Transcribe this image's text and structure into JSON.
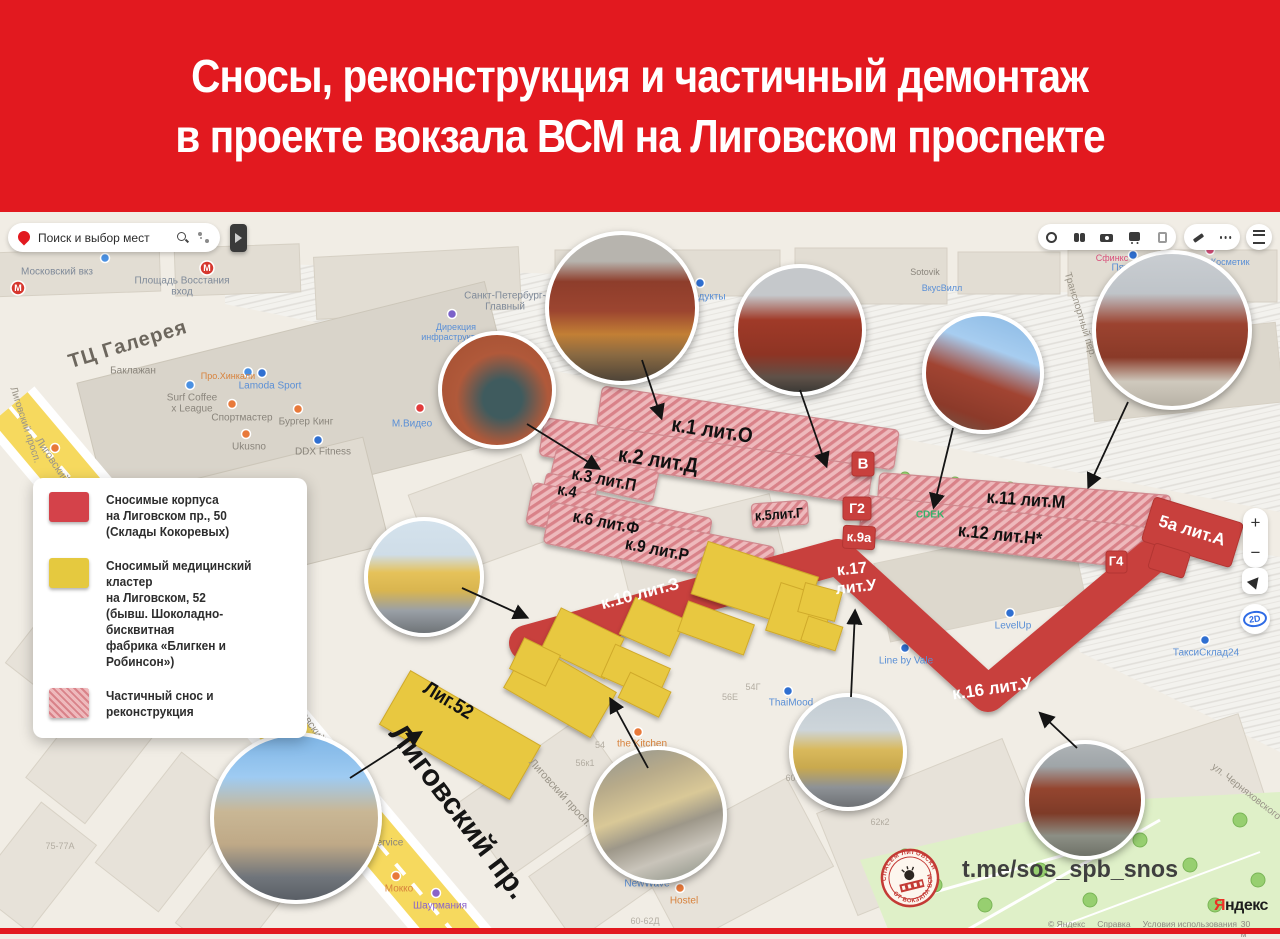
{
  "header": {
    "line1": "Сносы, реконструкция и частичный демонтаж",
    "line2": "в проекте вокзала ВСМ на Лиговском проспекте"
  },
  "search": {
    "placeholder": "Поиск и выбор мест"
  },
  "map_controls": {
    "zoom_in": "+",
    "zoom_out": "−",
    "view_2d": "2D"
  },
  "legend": {
    "items": [
      {
        "swatch": "red",
        "lines": [
          "Сносимые корпуса",
          "на Лиговском пр., 50",
          "(Склады Кокоревых)"
        ]
      },
      {
        "swatch": "yellow",
        "lines": [
          "Сносимый медицинский кластер",
          "на Лиговском, 52",
          "(бывш. Шоколадно-бисквитная",
          "фабрика «Блигкен и Робинсон»)"
        ]
      },
      {
        "swatch": "hatched",
        "lines": [
          "Частичный снос и реконструкция"
        ]
      }
    ]
  },
  "colors": {
    "banner_red": "#e2191f",
    "overlay_red": "#c8403e",
    "overlay_yellow": "#e8c83f",
    "hatch_pink": "#eeb9bc"
  },
  "building_labels": [
    {
      "t": "к.1 лит.О",
      "x": 712,
      "y": 431,
      "r": 8.5,
      "s": 21,
      "c": "#111",
      "w": 700,
      "sx": 0.9
    },
    {
      "t": "к.2 лит.Д",
      "x": 658,
      "y": 461,
      "r": 8.5,
      "s": 21,
      "c": "#111",
      "w": 700,
      "sx": 0.9
    },
    {
      "t": "к.3 лит.П",
      "x": 604,
      "y": 480,
      "r": 11,
      "s": 17,
      "c": "#111",
      "w": 700,
      "sx": 0.9
    },
    {
      "t": "к.4",
      "x": 567,
      "y": 492,
      "r": 11,
      "s": 16,
      "c": "#111",
      "w": 700,
      "sx": 0.9
    },
    {
      "t": "к.6 лит.Ф",
      "x": 606,
      "y": 523,
      "r": 11,
      "s": 17,
      "c": "#111",
      "w": 700,
      "sx": 0.9
    },
    {
      "t": "к.9 лит.Р",
      "x": 657,
      "y": 550,
      "r": 11,
      "s": 17,
      "c": "#111",
      "w": 700,
      "sx": 0.9
    },
    {
      "t": "к.5лит.Г",
      "x": 779,
      "y": 514,
      "r": -4,
      "s": 14,
      "c": "#111",
      "w": 700,
      "sx": 0.9
    },
    {
      "t": "к.11 лит.М",
      "x": 1026,
      "y": 500,
      "r": 4,
      "s": 18,
      "c": "#111",
      "w": 700,
      "sx": 0.9
    },
    {
      "t": "к.12 лит.Н*",
      "x": 1000,
      "y": 535,
      "r": 6,
      "s": 18,
      "c": "#111",
      "w": 700,
      "sx": 0.9
    },
    {
      "t": "В",
      "x": 863,
      "y": 464,
      "r": 0,
      "s": 15,
      "c": "#fff",
      "w": 700
    },
    {
      "t": "Г2",
      "x": 857,
      "y": 508,
      "r": 0,
      "s": 14,
      "c": "#fff",
      "w": 700
    },
    {
      "t": "к.9а",
      "x": 859,
      "y": 537,
      "r": 3,
      "s": 13,
      "c": "#fff",
      "w": 700
    },
    {
      "t": "Г4",
      "x": 1116,
      "y": 561,
      "r": 0,
      "s": 13,
      "c": "#fff",
      "w": 700
    },
    {
      "t": "5а лит.А",
      "x": 1192,
      "y": 531,
      "r": 17,
      "s": 17,
      "c": "#fff",
      "w": 700
    },
    {
      "t": "к.17",
      "x": 852,
      "y": 570,
      "r": -6,
      "s": 16,
      "c": "#fff",
      "w": 700
    },
    {
      "t": "лит.У",
      "x": 856,
      "y": 588,
      "r": -6,
      "s": 16,
      "c": "#fff",
      "w": 700
    },
    {
      "t": "к.16 лит.У",
      "x": 992,
      "y": 689,
      "r": -8,
      "s": 17,
      "c": "#fff",
      "w": 700
    },
    {
      "t": "к.10 лит.З",
      "x": 640,
      "y": 594,
      "r": -15,
      "s": 17,
      "c": "#fff",
      "w": 700
    },
    {
      "t": "Лиг.52",
      "x": 448,
      "y": 701,
      "r": 31,
      "s": 20,
      "c": "#111",
      "w": 700,
      "sx": 0.9
    }
  ],
  "map_labels": [
    {
      "t": "ТЦ Галерея",
      "x": 128,
      "y": 345,
      "r": -17,
      "s": 20,
      "c": "#6d675e",
      "w": 700,
      "ls": 1
    },
    {
      "t": "Лиговский пр.",
      "x": 458,
      "y": 812,
      "r": 53,
      "s": 30,
      "c": "#151515",
      "w": 700
    },
    {
      "t": "Лиговский просп.",
      "x": 62,
      "y": 475,
      "r": 56,
      "s": 11,
      "c": "#9a9488"
    },
    {
      "t": "Лиговский просп.",
      "x": 25,
      "y": 425,
      "r": 72,
      "s": 10,
      "c": "#9a9488"
    },
    {
      "t": "Лиговский просп.",
      "x": 318,
      "y": 735,
      "r": 55,
      "s": 11,
      "c": "#9a9488"
    },
    {
      "t": "Лиговский просп.",
      "x": 560,
      "y": 793,
      "r": 48,
      "s": 11,
      "c": "#9a9488"
    },
    {
      "t": "Транспортный пер.",
      "x": 1080,
      "y": 315,
      "r": 73,
      "s": 10,
      "c": "#9a9488"
    },
    {
      "t": "ул. Черняховского",
      "x": 1246,
      "y": 792,
      "r": 38,
      "s": 10,
      "c": "#9a9488"
    },
    {
      "t": "Московский вкз",
      "x": 57,
      "y": 272,
      "s": 10,
      "c": "#7f8a99"
    },
    {
      "t": "Площадь Восстания",
      "x": 182,
      "y": 281,
      "s": 10,
      "c": "#7f8a99"
    },
    {
      "t": "вход",
      "x": 182,
      "y": 292,
      "s": 10,
      "c": "#7f8a99"
    },
    {
      "t": "Санкт-Петербург-",
      "x": 505,
      "y": 296,
      "s": 10,
      "c": "#7f8a99"
    },
    {
      "t": "Главный",
      "x": 505,
      "y": 307,
      "s": 10,
      "c": "#7f8a99"
    },
    {
      "t": "Продукты",
      "x": 703,
      "y": 297,
      "s": 10,
      "c": "#5a8fd6"
    },
    {
      "t": "Кассовый",
      "x": 582,
      "y": 266,
      "s": 9,
      "c": "#5a8fd6"
    },
    {
      "t": "зал № 2",
      "x": 582,
      "y": 276,
      "s": 9,
      "c": "#5a8fd6"
    },
    {
      "t": "Дирекция",
      "x": 456,
      "y": 327,
      "s": 9,
      "c": "#5a8fd6"
    },
    {
      "t": "инфраструктуры",
      "x": 456,
      "y": 337,
      "s": 9,
      "c": "#5a8fd6"
    },
    {
      "t": "Баклажан",
      "x": 133,
      "y": 371,
      "s": 10,
      "c": "#8a857c"
    },
    {
      "t": "Surf Coffee",
      "x": 192,
      "y": 398,
      "s": 10,
      "c": "#8a857c"
    },
    {
      "t": "x League",
      "x": 192,
      "y": 409,
      "s": 10,
      "c": "#8a857c"
    },
    {
      "t": "Спортмастер",
      "x": 242,
      "y": 418,
      "s": 10,
      "c": "#8a857c"
    },
    {
      "t": "Бургер Кинг",
      "x": 306,
      "y": 422,
      "s": 10,
      "c": "#8a857c"
    },
    {
      "t": "Ukusno",
      "x": 249,
      "y": 447,
      "s": 10,
      "c": "#8a857c"
    },
    {
      "t": "DDX Fitness",
      "x": 323,
      "y": 452,
      "s": 10,
      "c": "#8a857c"
    },
    {
      "t": "Lamoda Sport",
      "x": 270,
      "y": 386,
      "s": 10,
      "c": "#5a8fd6"
    },
    {
      "t": "Про.Хинкали",
      "x": 228,
      "y": 376,
      "s": 9,
      "c": "#d8823c"
    },
    {
      "t": "М.Видео",
      "x": 412,
      "y": 424,
      "s": 10,
      "c": "#5a8fd6"
    },
    {
      "t": "Пятёрочка",
      "x": 1136,
      "y": 268,
      "s": 10,
      "c": "#5a8fd6"
    },
    {
      "t": "Магнит Косметик",
      "x": 1214,
      "y": 262,
      "s": 9,
      "c": "#5a8fd6"
    },
    {
      "t": "Сфинкс",
      "x": 1112,
      "y": 258,
      "s": 9,
      "c": "#d94f7a"
    },
    {
      "t": "ВкусВилл",
      "x": 942,
      "y": 288,
      "s": 9,
      "c": "#5a8fd6"
    },
    {
      "t": "Sotovik",
      "x": 925,
      "y": 272,
      "s": 9,
      "c": "#8a857c"
    },
    {
      "t": "CDEK",
      "x": 930,
      "y": 515,
      "s": 10,
      "c": "#35b36a",
      "w": 700
    },
    {
      "t": "Line by Vale",
      "x": 906,
      "y": 661,
      "s": 10,
      "c": "#5a8fd6"
    },
    {
      "t": "LevelUp",
      "x": 1013,
      "y": 626,
      "s": 10,
      "c": "#5a8fd6"
    },
    {
      "t": "ТаксиСклад24",
      "x": 1206,
      "y": 653,
      "s": 10,
      "c": "#5a8fd6"
    },
    {
      "t": "the Kitchen",
      "x": 642,
      "y": 744,
      "s": 10,
      "c": "#d8823c"
    },
    {
      "t": "ThaiMood",
      "x": 791,
      "y": 703,
      "s": 10,
      "c": "#5a8fd6"
    },
    {
      "t": "Block Service",
      "x": 373,
      "y": 843,
      "s": 10,
      "c": "#8a857c"
    },
    {
      "t": "Hustle",
      "x": 311,
      "y": 871,
      "s": 10,
      "c": "#d8823c"
    },
    {
      "t": "Lounge Bar",
      "x": 311,
      "y": 882,
      "s": 10,
      "c": "#d8823c"
    },
    {
      "t": "Мокко",
      "x": 399,
      "y": 889,
      "s": 10,
      "c": "#d8823c"
    },
    {
      "t": "NewWave",
      "x": 647,
      "y": 884,
      "s": 10,
      "c": "#5a8fd6"
    },
    {
      "t": "Hostel",
      "x": 684,
      "y": 901,
      "s": 10,
      "c": "#d8823c"
    },
    {
      "t": "Шаурмания",
      "x": 440,
      "y": 906,
      "s": 10,
      "c": "#8a63c9"
    },
    {
      "t": "54",
      "x": 600,
      "y": 745,
      "s": 9,
      "c": "#b3ada2"
    },
    {
      "t": "56к1",
      "x": 585,
      "y": 763,
      "s": 9,
      "c": "#b3ada2"
    },
    {
      "t": "56Е",
      "x": 730,
      "y": 697,
      "s": 9,
      "c": "#b3ada2"
    },
    {
      "t": "54Г",
      "x": 753,
      "y": 687,
      "s": 9,
      "c": "#b3ada2"
    },
    {
      "t": "60к3",
      "x": 795,
      "y": 778,
      "s": 9,
      "c": "#b3ada2"
    },
    {
      "t": "62к2",
      "x": 880,
      "y": 822,
      "s": 9,
      "c": "#b3ada2"
    },
    {
      "t": "60-62Д",
      "x": 645,
      "y": 921,
      "s": 9,
      "c": "#b3ada2"
    },
    {
      "t": "75-77А",
      "x": 60,
      "y": 846,
      "s": 9,
      "c": "#b3ada2"
    },
    {
      "t": "М",
      "x": 18,
      "y": 288,
      "s": 9,
      "c": "#ffffff",
      "w": 700
    },
    {
      "t": "М",
      "x": 207,
      "y": 268,
      "s": 9,
      "c": "#ffffff",
      "w": 700
    }
  ],
  "photos": [
    {
      "x": 622,
      "y": 308,
      "r": 73,
      "kind": "red-building-autumn"
    },
    {
      "x": 800,
      "y": 330,
      "r": 62,
      "kind": "red-brick-facade"
    },
    {
      "x": 983,
      "y": 373,
      "r": 57,
      "kind": "brick-blue-sky"
    },
    {
      "x": 1172,
      "y": 330,
      "r": 76,
      "kind": "brick-station"
    },
    {
      "x": 497,
      "y": 390,
      "r": 55,
      "kind": "mural-wall"
    },
    {
      "x": 424,
      "y": 577,
      "r": 56,
      "kind": "yellow-classic"
    },
    {
      "x": 296,
      "y": 818,
      "r": 82,
      "kind": "modern-block"
    },
    {
      "x": 658,
      "y": 815,
      "r": 65,
      "kind": "aerial-courtyard"
    },
    {
      "x": 848,
      "y": 752,
      "r": 55,
      "kind": "yellow-street"
    },
    {
      "x": 1085,
      "y": 800,
      "r": 56,
      "kind": "brick-alley"
    }
  ],
  "arrows": [
    {
      "x1": 527,
      "y1": 424,
      "x2": 598,
      "y2": 468
    },
    {
      "x1": 642,
      "y1": 360,
      "x2": 661,
      "y2": 417
    },
    {
      "x1": 800,
      "y1": 390,
      "x2": 826,
      "y2": 465
    },
    {
      "x1": 953,
      "y1": 428,
      "x2": 934,
      "y2": 506
    },
    {
      "x1": 1128,
      "y1": 402,
      "x2": 1089,
      "y2": 486
    },
    {
      "x1": 462,
      "y1": 588,
      "x2": 526,
      "y2": 617
    },
    {
      "x1": 350,
      "y1": 778,
      "x2": 420,
      "y2": 733
    },
    {
      "x1": 648,
      "y1": 768,
      "x2": 611,
      "y2": 700
    },
    {
      "x1": 851,
      "y1": 697,
      "x2": 855,
      "y2": 612
    },
    {
      "x1": 1077,
      "y1": 748,
      "x2": 1041,
      "y2": 714
    }
  ],
  "badge": {
    "top_text": "СПАСЁМ ЛИГОВСКИЙ 50",
    "bottom_text": "ОТ ВОКЗАЛА ВСМ!"
  },
  "footer": {
    "telegram": "t.me/sos_spb_snos",
    "logo_ya": "Я",
    "logo_rest": "ндекс",
    "attribution": [
      "© Яндекс",
      "Справка",
      "Условия использования"
    ],
    "scale_label": "30 м"
  }
}
